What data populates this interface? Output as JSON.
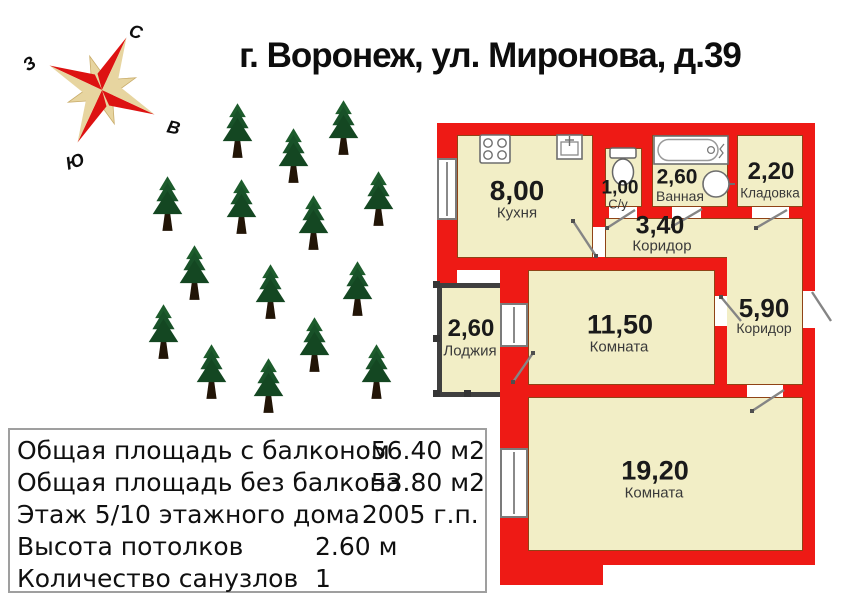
{
  "title": "г. Воронеж, ул. Миронова, д.39",
  "compass": {
    "north": "С",
    "west": "З",
    "east": "В",
    "south": "Ю"
  },
  "site_plan": {
    "tree_count": 15,
    "trees": [
      {
        "x": 237,
        "y": 130
      },
      {
        "x": 293,
        "y": 155
      },
      {
        "x": 343,
        "y": 127
      },
      {
        "x": 167,
        "y": 203
      },
      {
        "x": 241,
        "y": 206
      },
      {
        "x": 313,
        "y": 222
      },
      {
        "x": 378,
        "y": 198
      },
      {
        "x": 194,
        "y": 272
      },
      {
        "x": 270,
        "y": 291
      },
      {
        "x": 357,
        "y": 288
      },
      {
        "x": 163,
        "y": 331
      },
      {
        "x": 314,
        "y": 344
      },
      {
        "x": 211,
        "y": 371
      },
      {
        "x": 268,
        "y": 385
      },
      {
        "x": 376,
        "y": 371
      }
    ]
  },
  "plan": {
    "rooms": [
      {
        "area": "8,00",
        "name": "Кухня"
      },
      {
        "area": "1,00",
        "name": "С/у"
      },
      {
        "area": "2,60",
        "name": "Ванная"
      },
      {
        "area": "2,20",
        "name": "Кладовка"
      },
      {
        "area": "3,40",
        "name": "Коридор"
      },
      {
        "area": "2,60",
        "name": "Лоджия"
      },
      {
        "area": "11,50",
        "name": "Комната"
      },
      {
        "area": "5,90",
        "name": "Коридор"
      },
      {
        "area": "19,20",
        "name": "Комната"
      }
    ],
    "fixtures": [
      "stove",
      "kitchen-sink",
      "toilet",
      "bathtub",
      "washbasin"
    ]
  },
  "info_box": {
    "rows": [
      {
        "label": "Общая площадь с балконом",
        "value": "56.40 м2"
      },
      {
        "label": "Общая площадь без балкона",
        "value": "53.80 м2"
      },
      {
        "label": "Этаж 5/10 этажного дома",
        "value": "2005 г.п."
      },
      {
        "label": "Высота потолков",
        "value": "2.60 м"
      },
      {
        "label": "Количество санузлов",
        "value": "1"
      }
    ]
  },
  "colors": {
    "wall_red": "#ee1a15",
    "room_fill": "#f2eec6",
    "balcony_wall": "#3f3f3f",
    "tree_green": "#1d5c2c",
    "compass_red": "#dd1212",
    "compass_beige": "#e7d5a0"
  }
}
